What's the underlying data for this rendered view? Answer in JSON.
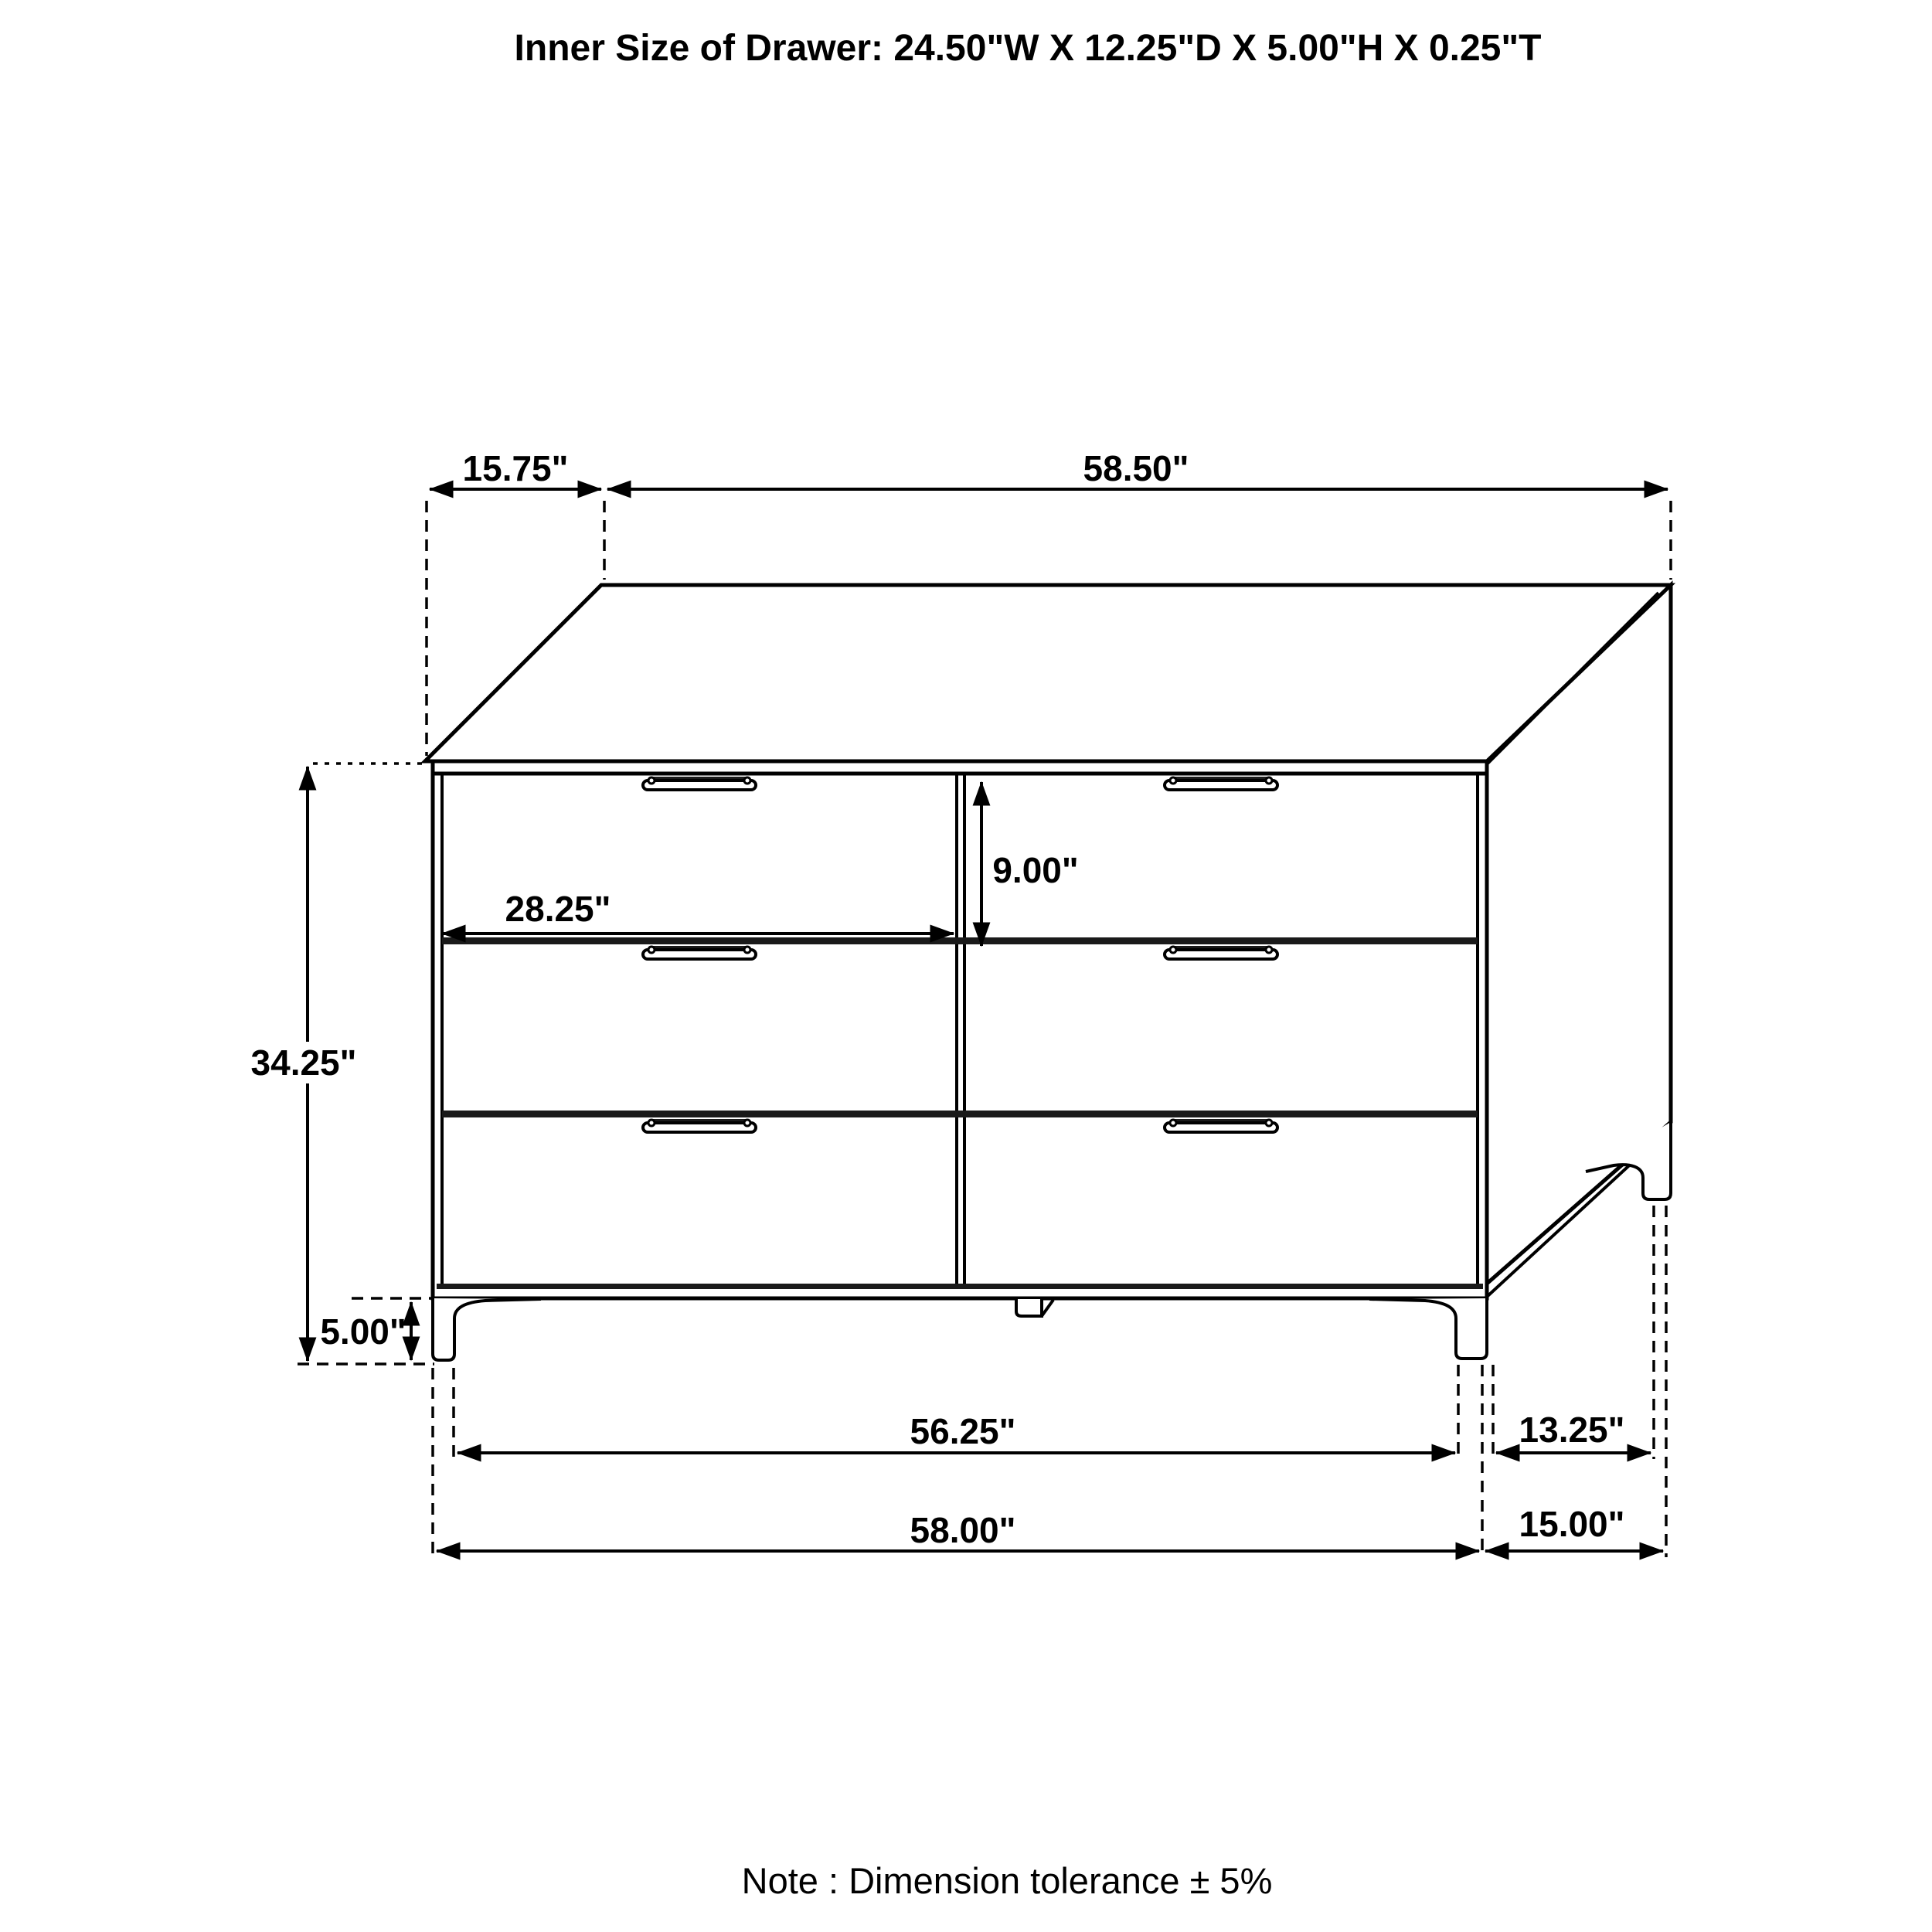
{
  "title": "Inner Size of Drawer: 24.50\"W X 12.25\"D X 5.00\"H X 0.25\"T",
  "note": "Note : Dimension tolerance  ± 5%",
  "dimensions": {
    "top_depth_offset": "15.75\"",
    "top_width": "58.50\"",
    "drawer_height": "9.00\"",
    "drawer_width": "28.25\"",
    "overall_height": "34.25\"",
    "leg_height": "5.00\"",
    "feet_span_width": "56.25\"",
    "base_width": "58.00\"",
    "feet_span_depth": "13.25\"",
    "base_depth": "15.00\""
  },
  "object": {
    "type": "6-drawer dresser",
    "drawer_columns": 2,
    "drawer_rows": 3
  },
  "colors": {
    "line": "#000000",
    "background": "#ffffff",
    "dark_fill": "#1a1a1a"
  }
}
